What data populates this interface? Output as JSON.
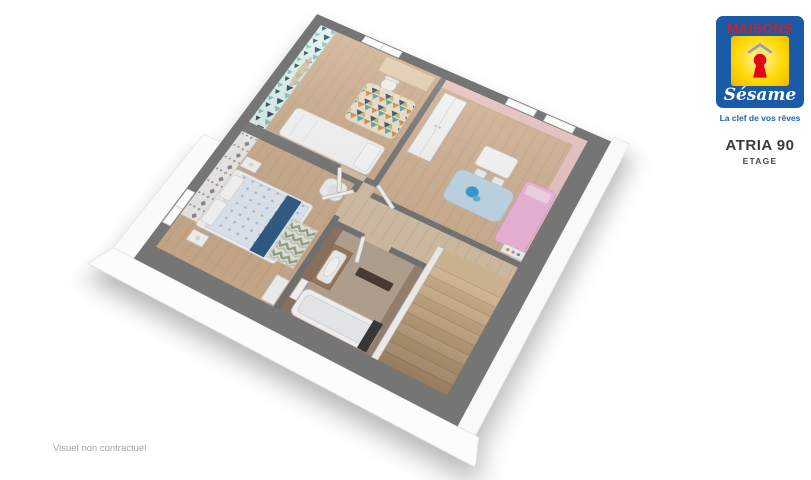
{
  "page": {
    "background": "#ffffff",
    "footnote": "Visuel non contractuel"
  },
  "brand": {
    "wordmark": "MAISONS",
    "script": "Sésame",
    "tagline": "La clef de vos rêves",
    "colors": {
      "blue": "#1b5aa6",
      "red": "#c1272d",
      "yellow": "#ffd903",
      "keyhole_red": "#e30613"
    }
  },
  "plan": {
    "title": "ATRIA 90",
    "subtitle": "ETAGE"
  },
  "floorplan": {
    "type": "3d-cutaway-floorplan",
    "wall_top_color": "#757575",
    "rooms": [
      {
        "id": "bedroom-1",
        "position": "top",
        "floor_color": "#cfae8e",
        "accent": "teal-triangle-wallpaper",
        "furniture": [
          "single-bed",
          "desk",
          "chair",
          "mosaic-rug",
          "wall-garland",
          "window"
        ]
      },
      {
        "id": "bedroom-2",
        "position": "right",
        "floor_color": "#d4b494",
        "accent": "pink-walls",
        "furniture": [
          "wardrobe",
          "kids-table",
          "kids-chairs",
          "blue-rug",
          "toy",
          "pink-bed",
          "bookshelf",
          "windows"
        ]
      },
      {
        "id": "master-bedroom",
        "position": "left",
        "floor_color": "#cfae8e",
        "accent": "gray-damask-wallpaper",
        "furniture": [
          "double-bed",
          "blue-runner",
          "pillows",
          "nightstands",
          "lamps",
          "armchair",
          "chevron-rug",
          "closet",
          "window"
        ]
      },
      {
        "id": "bathroom",
        "position": "bottom-center",
        "floor_color": "#b9a795",
        "accent": "taupe-wood-walls",
        "furniture": [
          "vanity-sink",
          "bath-mat",
          "bathtub",
          "towel-radiator"
        ]
      },
      {
        "id": "landing-hallway",
        "position": "center",
        "floor_color": "#d8c3a8",
        "furniture": [
          "open-doors"
        ]
      },
      {
        "id": "staircase",
        "position": "bottom-right",
        "floor_color": "#d9bd97",
        "furniture": [
          "wood-steps",
          "guard-wall"
        ]
      }
    ]
  }
}
